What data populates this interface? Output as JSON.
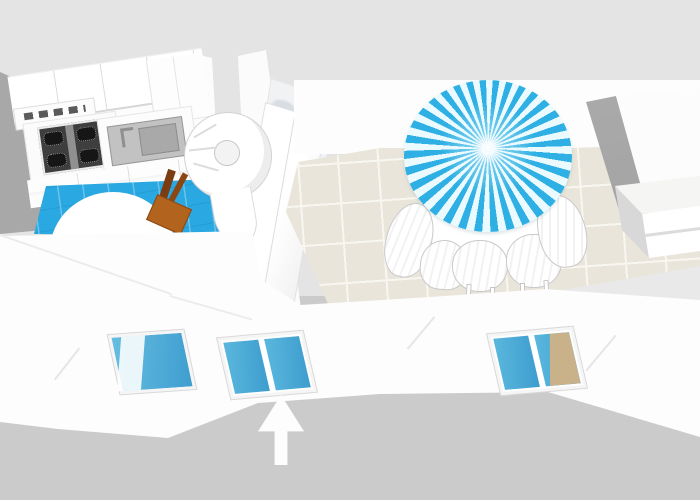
{
  "app": {
    "name": "floor-plan-3d-viewer",
    "view": "3d-overview"
  },
  "palette": {
    "background_top": "#e4e4e4",
    "background_bottom": "#cbcbcb",
    "side_wall_gray": "#a8a8a8",
    "wall_white": "#fdfdfd",
    "kitchen_floor_blue": "#2aa8e1",
    "dining_floor_beige": "#e9e5da",
    "tile_grout": "#f8f6f0",
    "umbrella_blue": "#2fb0e4",
    "umbrella_white": "#ebfaff",
    "window_glass_blue": "#4cb0d9",
    "window_reflection_tan": "#c9b189",
    "chair_wood_seat": "#b2641e",
    "chair_wood_back": "#7a3c10",
    "cooktop_dark": "#3e3e3e",
    "sink_gray": "#c2c2c2",
    "wardrobe_side_gray": "#a4a4a4",
    "arrow_white": "#fdfdfd"
  },
  "scene": {
    "description": "3D overhead floor-plan render of a two-room apartment",
    "rooms": [
      {
        "id": "kitchen",
        "floor": "blue tile",
        "objects": [
          "upper-cabinets",
          "corner-cabinet",
          "range-hood",
          "gas-cooktop-4-burner",
          "kitchen-sink",
          "base-cabinets",
          "round-white-table",
          "wooden-chair",
          "spiral-staircase"
        ]
      },
      {
        "id": "dining-room",
        "floor": "beige tile",
        "objects": [
          "partition-wall",
          "marble-feature-panel",
          "tall-cabinet",
          "striped-patio-umbrella",
          "round-dining-table",
          "white-dining-chairs",
          "wardrobe",
          "low-dresser"
        ]
      }
    ],
    "counts": {
      "rooms": 2,
      "cooktop_burners": 4,
      "dining_chairs": 5,
      "windows": 3
    },
    "windows": [
      {
        "id": "small-casement-window",
        "wall": "front-left",
        "glass": "blue"
      },
      {
        "id": "double-window-center",
        "wall": "front-center",
        "glass": "blue"
      },
      {
        "id": "double-window-right",
        "wall": "front-right",
        "glass": "blue with tan reflection"
      }
    ],
    "annotation": {
      "id": "entry-arrow",
      "type": "up-arrow",
      "points_at": "double-window-center",
      "color": "#ffffff"
    }
  }
}
